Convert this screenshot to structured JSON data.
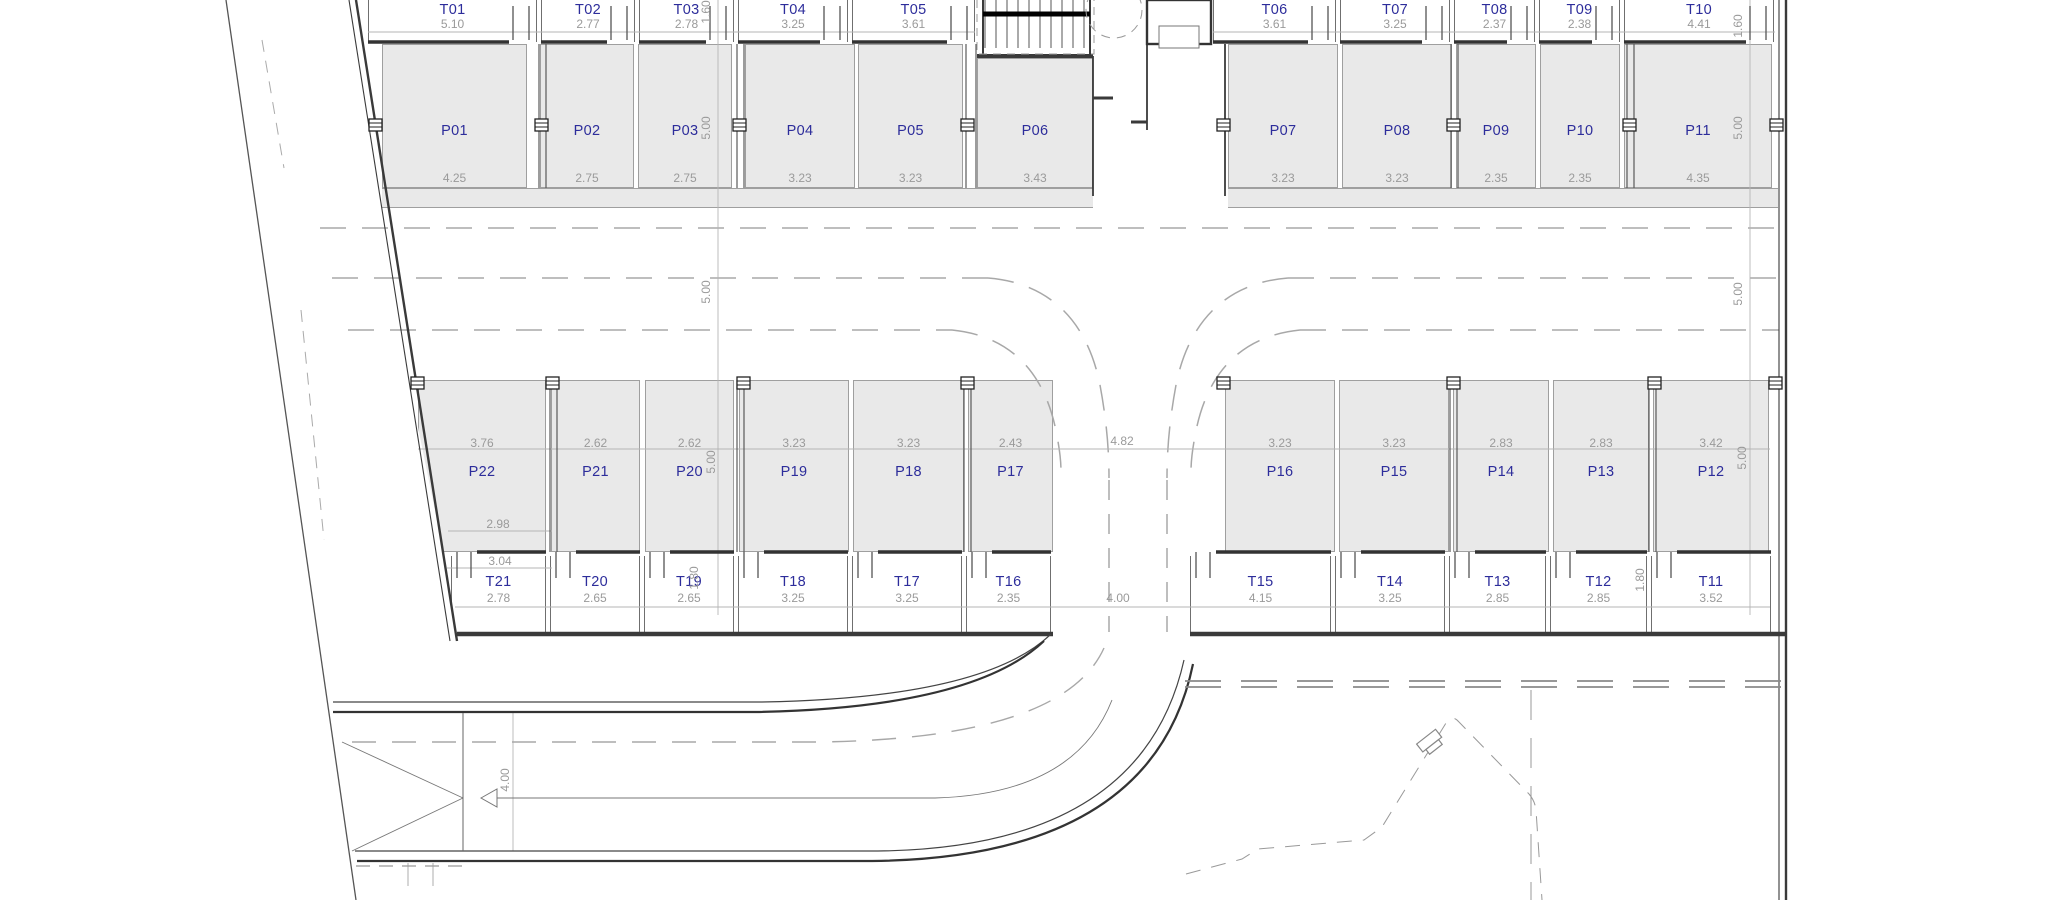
{
  "meta": {
    "drawing_type": "parking-level floor plan",
    "canvas_w": 2048,
    "canvas_h": 900
  },
  "colors": {
    "background": "#ffffff",
    "space_fill": "#e9e9e9",
    "unit_label": "#2d2d9b",
    "dimension_label": "#9a9a9a",
    "wall": "#3a3a3a"
  },
  "unit_blocks": [
    {
      "name": "top-left-storage",
      "kind": "storage",
      "y": 0,
      "h": 42,
      "label_cy": 10,
      "dim_cy": 24,
      "units": [
        {
          "label": "T01",
          "dim": "5.10",
          "x": 368,
          "w": 169
        },
        {
          "label": "T02",
          "dim": "2.77",
          "x": 541,
          "w": 94
        },
        {
          "label": "T03",
          "dim": "2.78",
          "x": 639,
          "w": 95
        },
        {
          "label": "T04",
          "dim": "3.25",
          "x": 738,
          "w": 110
        },
        {
          "label": "T05",
          "dim": "3.61",
          "x": 852,
          "w": 123
        }
      ]
    },
    {
      "name": "top-right-storage",
      "kind": "storage",
      "y": 0,
      "h": 42,
      "label_cy": 10,
      "dim_cy": 24,
      "units": [
        {
          "label": "T06",
          "dim": "3.61",
          "x": 1213,
          "w": 123
        },
        {
          "label": "T07",
          "dim": "3.25",
          "x": 1340,
          "w": 110
        },
        {
          "label": "T08",
          "dim": "2.37",
          "x": 1454,
          "w": 81
        },
        {
          "label": "T09",
          "dim": "2.38",
          "x": 1539,
          "w": 81
        },
        {
          "label": "T10",
          "dim": "4.41",
          "x": 1624,
          "w": 150
        }
      ]
    },
    {
      "name": "top-left-parking",
      "kind": "parking",
      "y": 44,
      "h": 144,
      "label_cy": 86,
      "dim_cy": 133,
      "units": [
        {
          "label": "P01",
          "dim": "4.25",
          "x": 382,
          "w": 145
        },
        {
          "label": "P02",
          "dim": "2.75",
          "x": 540,
          "w": 94
        },
        {
          "label": "P03",
          "dim": "2.75",
          "x": 638,
          "w": 94
        },
        {
          "label": "P04",
          "dim": "3.23",
          "x": 745,
          "w": 110
        },
        {
          "label": "P05",
          "dim": "3.23",
          "x": 858,
          "w": 105
        },
        {
          "label": "P06",
          "dim": "3.43",
          "x": 977,
          "w": 116,
          "dy": 14
        }
      ]
    },
    {
      "name": "top-right-parking",
      "kind": "parking",
      "y": 44,
      "h": 144,
      "label_cy": 86,
      "dim_cy": 133,
      "units": [
        {
          "label": "P07",
          "dim": "3.23",
          "x": 1228,
          "w": 110
        },
        {
          "label": "P08",
          "dim": "3.23",
          "x": 1342,
          "w": 110
        },
        {
          "label": "P09",
          "dim": "2.35",
          "x": 1456,
          "w": 80
        },
        {
          "label": "P10",
          "dim": "2.35",
          "x": 1540,
          "w": 80
        },
        {
          "label": "P11",
          "dim": "4.35",
          "x": 1624,
          "w": 148
        }
      ]
    },
    {
      "name": "bottom-left-parking",
      "kind": "parking",
      "y": 380,
      "h": 172,
      "label_cy": 91,
      "dim_cy": 62,
      "units": [
        {
          "label": "P22",
          "dim": "3.76",
          "x": 418,
          "w": 128
        },
        {
          "label": "P21",
          "dim": "2.62",
          "x": 551,
          "w": 89
        },
        {
          "label": "P20",
          "dim": "2.62",
          "x": 645,
          "w": 89
        },
        {
          "label": "P19",
          "dim": "3.23",
          "x": 739,
          "w": 110
        },
        {
          "label": "P18",
          "dim": "3.23",
          "x": 853,
          "w": 111
        },
        {
          "label": "P17",
          "dim": "2.43",
          "x": 968,
          "w": 85
        }
      ]
    },
    {
      "name": "bottom-right-parking",
      "kind": "parking",
      "y": 380,
      "h": 172,
      "label_cy": 91,
      "dim_cy": 62,
      "units": [
        {
          "label": "P16",
          "dim": "3.23",
          "x": 1225,
          "w": 110
        },
        {
          "label": "P15",
          "dim": "3.23",
          "x": 1339,
          "w": 110
        },
        {
          "label": "P14",
          "dim": "2.83",
          "x": 1453,
          "w": 96
        },
        {
          "label": "P13",
          "dim": "2.83",
          "x": 1553,
          "w": 96
        },
        {
          "label": "P12",
          "dim": "3.42",
          "x": 1653,
          "w": 116
        }
      ]
    },
    {
      "name": "bottom-left-storage",
      "kind": "storage",
      "y": 556,
      "h": 76,
      "label_cy": 26,
      "dim_cy": 42,
      "units": [
        {
          "label": "T21",
          "dim": "2.78",
          "x": 451,
          "w": 95
        },
        {
          "label": "T20",
          "dim": "2.65",
          "x": 550,
          "w": 90
        },
        {
          "label": "T19",
          "dim": "2.65",
          "x": 644,
          "w": 90
        },
        {
          "label": "T18",
          "dim": "3.25",
          "x": 738,
          "w": 110
        },
        {
          "label": "T17",
          "dim": "3.25",
          "x": 852,
          "w": 110
        },
        {
          "label": "T16",
          "dim": "2.35",
          "x": 966,
          "w": 85
        }
      ]
    },
    {
      "name": "bottom-right-storage",
      "kind": "storage",
      "y": 556,
      "h": 76,
      "label_cy": 26,
      "dim_cy": 42,
      "units": [
        {
          "label": "T15",
          "dim": "4.15",
          "x": 1190,
          "w": 141
        },
        {
          "label": "T14",
          "dim": "3.25",
          "x": 1335,
          "w": 110
        },
        {
          "label": "T13",
          "dim": "2.85",
          "x": 1449,
          "w": 97
        },
        {
          "label": "T12",
          "dim": "2.85",
          "x": 1550,
          "w": 97
        },
        {
          "label": "T11",
          "dim": "3.52",
          "x": 1651,
          "w": 120
        }
      ]
    }
  ],
  "dims": {
    "rotated": [
      {
        "t": "1.60",
        "x": 706,
        "y": 12
      },
      {
        "t": "5.00",
        "x": 706,
        "y": 128
      },
      {
        "t": "5.00",
        "x": 706,
        "y": 292
      },
      {
        "t": "5.00",
        "x": 711,
        "y": 462
      },
      {
        "t": "1.80",
        "x": 694,
        "y": 578
      },
      {
        "t": "1.60",
        "x": 1738,
        "y": 26
      },
      {
        "t": "5.00",
        "x": 1738,
        "y": 128
      },
      {
        "t": "5.00",
        "x": 1738,
        "y": 294
      },
      {
        "t": "5.00",
        "x": 1742,
        "y": 458
      },
      {
        "t": "1.80",
        "x": 1640,
        "y": 580
      },
      {
        "t": "4.00",
        "x": 505,
        "y": 780
      }
    ],
    "floating": [
      {
        "t": "2.98",
        "x": 498,
        "y": 524
      },
      {
        "t": "3.04",
        "x": 500,
        "y": 561
      },
      {
        "t": "4.82",
        "x": 1122,
        "y": 441
      },
      {
        "t": "4.00",
        "x": 1118,
        "y": 598
      }
    ]
  }
}
